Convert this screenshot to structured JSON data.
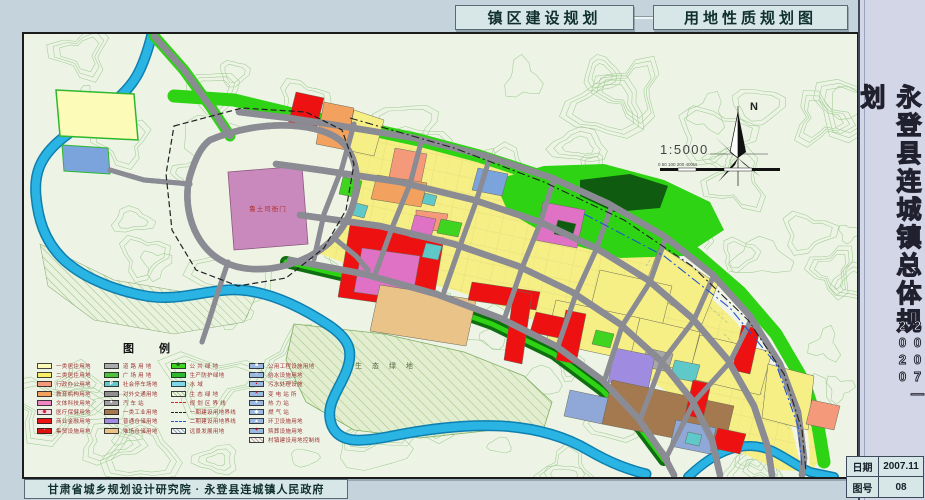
{
  "titles": {
    "left": "镇区建设规划",
    "right": "用地性质规划图"
  },
  "sidebar": {
    "title": "永登县连城镇总体规划",
    "period": "2007—2020",
    "info": [
      {
        "label": "日期",
        "value": "2007.11"
      },
      {
        "label": "图号",
        "value": "08"
      }
    ]
  },
  "footer": {
    "credit": "甘肃省城乡规划设计研究院 · 永登县连城镇人民政府"
  },
  "map": {
    "north_label": "N",
    "scale_text": "1:5000",
    "scale_ticks": "0  50 100   200        400M",
    "labels": {
      "heritage": "鲁土司衙门",
      "eco": "生 态 绿 地"
    },
    "colors": {
      "background": "#edf4e6",
      "contour": "#8fc17f",
      "water": "#29b4e4",
      "green": "#2ed314",
      "residential": "#f6ef86",
      "commercial": "#ee1111",
      "road": "#b5b5b5"
    }
  },
  "legend": {
    "title": "图  例",
    "columns": [
      [
        {
          "label": "一类居住用地",
          "type": "fill",
          "color": "#fdfbb8"
        },
        {
          "label": "二类居住用地",
          "type": "fill",
          "color": "#f8ee6a"
        },
        {
          "label": "行政办公用地",
          "type": "fill",
          "color": "#f49a7a"
        },
        {
          "label": "教育机构用地",
          "type": "fill",
          "color": "#f2a15e"
        },
        {
          "label": "文体科技用地",
          "type": "fill",
          "color": "#ee86c2"
        },
        {
          "label": "医疗保健用地",
          "type": "fill",
          "color": "#f6d5e2",
          "sym": "⊕",
          "symColor": "#cc0000"
        },
        {
          "label": "商业金融用地",
          "type": "fill",
          "color": "#ee1111"
        },
        {
          "label": "集贸设施用地",
          "type": "fill",
          "color": "#e01010",
          "sym": "◦",
          "symColor": "#ffffff"
        }
      ],
      [
        {
          "label": "道 路 用 地",
          "type": "fill",
          "color": "#ababab"
        },
        {
          "label": "广 场 用 地",
          "type": "fill",
          "color": "#4ec23e"
        },
        {
          "label": "社会停车场地",
          "type": "fill",
          "color": "#62c8c8",
          "sym": "P",
          "symColor": "#ffffff"
        },
        {
          "label": "对外交通用地",
          "type": "fill",
          "color": "#8f8f8f"
        },
        {
          "label": "汽 车 站",
          "type": "fill",
          "color": "#a0a0a0",
          "sym": "●",
          "symColor": "#ffffff"
        },
        {
          "label": "一类工业用地",
          "type": "fill",
          "color": "#a5794f"
        },
        {
          "label": "普通仓储用地",
          "type": "fill",
          "color": "#9f8ce0"
        },
        {
          "label": "堆场仓储用地",
          "type": "fill",
          "color": "#e9c387"
        }
      ],
      [
        {
          "label": "公 共 绿 地",
          "type": "fill",
          "color": "#3fd41f",
          "sym": "✽",
          "symColor": "#116611"
        },
        {
          "label": "生产防护绿地",
          "type": "fill",
          "color": "#2eb82e"
        },
        {
          "label": "水        域",
          "type": "fill",
          "color": "#7fd8ea"
        },
        {
          "label": "生 态 绿 地",
          "type": "hatch",
          "color": "#a6c68a"
        },
        {
          "label": "规 划 区 界 线",
          "type": "line",
          "color": "#dd2222"
        },
        {
          "label": "一期建设用地界线",
          "type": "line",
          "color": "#222222"
        },
        {
          "label": "二期建设用地界线",
          "type": "line",
          "color": "#2255cc"
        },
        {
          "label": "远景发展用地",
          "type": "hatch",
          "color": "#8fa8cc"
        }
      ],
      [
        {
          "label": "公用工程设施用地",
          "type": "fill",
          "color": "#9ab8e0",
          "sym": "■",
          "symColor": "#ffffff"
        },
        {
          "label": "给水设施用地",
          "type": "fill",
          "color": "#9ab8e0",
          "sym": "○",
          "symColor": "#ffffff"
        },
        {
          "label": "污水处理设施",
          "type": "fill",
          "color": "#9ab8e0",
          "sym": "▪",
          "symColor": "#cc0000"
        },
        {
          "label": "变 电 站 所",
          "type": "fill",
          "color": "#9ab8e0",
          "sym": "×",
          "symColor": "#cc0000"
        },
        {
          "label": "热 力 站",
          "type": "fill",
          "color": "#9ab8e0",
          "sym": "●",
          "symColor": "#ffffff"
        },
        {
          "label": "燃 气 站",
          "type": "fill",
          "color": "#9ab8e0",
          "sym": "◆",
          "symColor": "#ffffff"
        },
        {
          "label": "环卫设施用地",
          "type": "fill",
          "color": "#9ab8e0",
          "sym": "▲",
          "symColor": "#ffffff"
        },
        {
          "label": "殡葬设施用地",
          "type": "fill",
          "color": "#9ab8e0",
          "sym": "+",
          "symColor": "#cc0000"
        },
        {
          "label": "村镇建设用地控制线",
          "type": "hatch",
          "color": "#c0a8a8"
        }
      ]
    ]
  }
}
